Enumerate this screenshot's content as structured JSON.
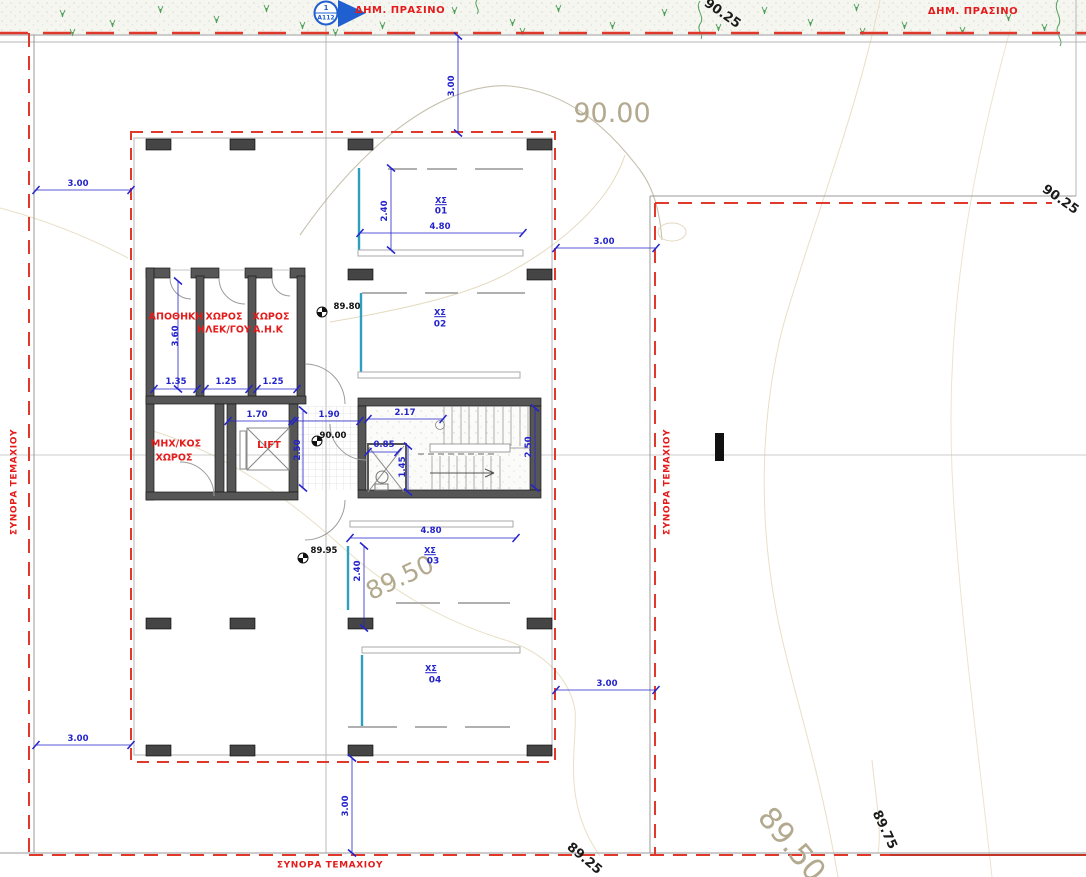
{
  "colors": {
    "boundary_red": "#e0392b",
    "dimension_blue": "#2323cc",
    "label_red": "#e41b1b",
    "contour_beige": "#b3a98f",
    "wall_gray": "#555555",
    "parking_cyan": "#2e9fbe",
    "grass_green": "#4f9f5a",
    "marker_blue": "#1f5fd0"
  },
  "site": {
    "public_green_left": "ΔΗΜ. ΠΡΑΣΙΝΟ",
    "public_green_right": "ΔΗΜ. ΠΡΑΣΙΝΟ",
    "boundary_left": "ΣΥΝΟΡΑ ΤΕΜΑΧΙΟΥ",
    "boundary_right": "ΣΥΝΟΡΑ ΤΕΜΑΧΙΟΥ",
    "boundary_bottom": "ΣΥΝΟΡΑ ΤΕΜΑΧΙΟΥ"
  },
  "section_marker": {
    "number": "1",
    "sheet": "A112"
  },
  "rooms": {
    "storage": "ΑΠΟΘΗΚΗ",
    "electrical_line1": "ΧΩΡΟΣ",
    "electrical_line2": "ΗΛΕΚ/ΓΟΥ",
    "ahk_line1": "ΧΩΡΟΣ",
    "ahk_line2": "Α.Η.Κ",
    "mechanical_line1": "ΜΗΧ/ΚΟΣ",
    "mechanical_line2": "ΧΩΡΟΣ",
    "lift": "LIFT"
  },
  "parking": {
    "spot1": {
      "tag": "ΧΣ",
      "num": "01"
    },
    "spot2": {
      "tag": "ΧΣ",
      "num": "02"
    },
    "spot3": {
      "tag": "ΧΣ",
      "num": "03"
    },
    "spot4": {
      "tag": "ΧΣ",
      "num": "04"
    }
  },
  "contour_labels": {
    "top": "90.25",
    "right": "90.25",
    "c90": "90.00",
    "mid": "89.50",
    "bottom_left": "89.25",
    "bottom_right_large": "89.50",
    "bottom_right_small": "89.75"
  },
  "spot_elevations": {
    "upper": "89.80",
    "center": "90.00",
    "lower": "89.95"
  },
  "dimensions": {
    "offset_top": "3.00",
    "offset_left_top": "3.00",
    "offset_left_bottom": "3.00",
    "offset_right_top": "3.00",
    "offset_right_bottom": "3.00",
    "offset_bottom": "3.00",
    "parking1_depth": "2.40",
    "parking1_width": "4.80",
    "parking3_depth": "2.40",
    "parking3_width": "4.80",
    "storage_width": "1.35",
    "electrical_width": "1.25",
    "ahk_width": "1.25",
    "storage_depth": "3.60",
    "lift_width": "1.70",
    "corridor_width": "1.90",
    "stair_width": "2.17",
    "corridor_depth": "2.50",
    "stair_depth": "2.50",
    "wc_width": "0.85",
    "wc_depth": "1.45"
  }
}
